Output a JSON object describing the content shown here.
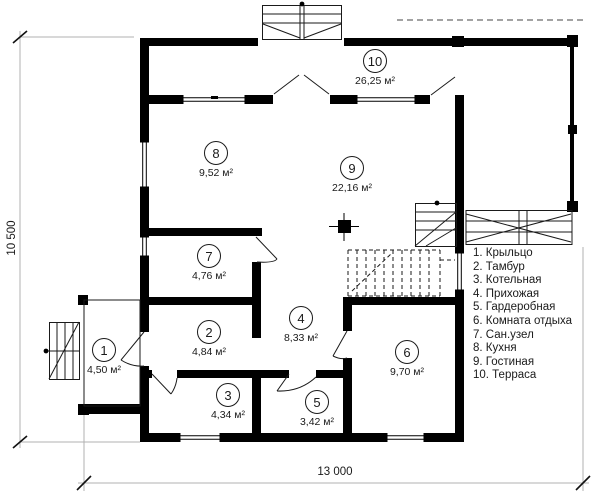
{
  "plan": {
    "rooms": [
      {
        "number": "1",
        "area": "4,50 м²"
      },
      {
        "number": "2",
        "area": "4,84 м²"
      },
      {
        "number": "3",
        "area": "4,34 м²"
      },
      {
        "number": "4",
        "area": "8,33 м²"
      },
      {
        "number": "5",
        "area": "3,42 м²"
      },
      {
        "number": "6",
        "area": "9,70 м²"
      },
      {
        "number": "7",
        "area": "4,76 м²"
      },
      {
        "number": "8",
        "area": "9,52 м²"
      },
      {
        "number": "9",
        "area": "22,16 м²"
      },
      {
        "number": "10",
        "area": "26,25 м²"
      }
    ],
    "legend": {
      "items": [
        "1. Крыльцо",
        "2. Тамбур",
        "3. Котельная",
        "4. Прихожая",
        "5. Гардеробная",
        "6. Комната отдыха",
        "7. Сан.узел",
        "8. Кухня",
        "9. Гостиная",
        "10. Терраса"
      ]
    },
    "dimensions": {
      "width": "13 000",
      "height": "10 500"
    },
    "colors": {
      "wall": "#000000",
      "thin_line": "#1a1a1a",
      "dim_line": "#a8a8a8",
      "background": "#ffffff"
    }
  }
}
